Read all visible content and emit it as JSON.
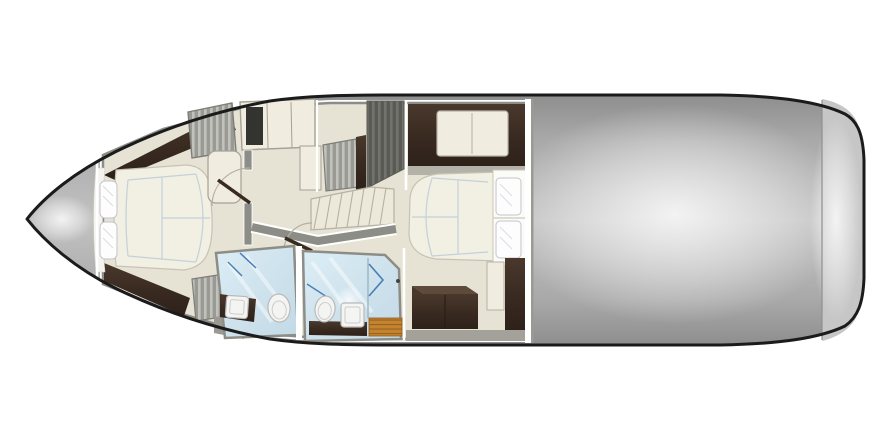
{
  "title": "Yacht lower-deck floor plan",
  "colors": {
    "background": "#ffffff",
    "hullOutline": "#1b1b1b",
    "deckGray": "#b0b0b0",
    "sternBand": "#c6c6c6",
    "wallGray": "#8d8d87",
    "wallGrayLight": "#b4b1a9",
    "floorCream": "#e7e3d4",
    "furnitureCream": "#f0ecdf",
    "bedCream": "#f2efe3",
    "stairCream": "#ece8da",
    "quiltBlue": "#bfcdd8",
    "darkPanel": "#33332f",
    "bathBlue": "#cfe3ee",
    "accentBlue": "#4a7fb5",
    "teak": "#c5832f",
    "pillowWhite": "#fdfdfd",
    "nicheWhite": "#fbfbf8",
    "headboardWhite": "#f4f3ee",
    "fixtureWhite": "#f4f4f2",
    "deckWedge": "#9b9993",
    "bottomBand": "#a3a19a"
  },
  "rooms": [
    {
      "id": "bow-deck",
      "label": "bow deck"
    },
    {
      "id": "forward-cabin",
      "label": "forward cabin",
      "features": [
        "island berth",
        "two pillows",
        "hanging lockers",
        "cabinet row",
        "vanity"
      ]
    },
    {
      "id": "forward-head",
      "label": "forward bathroom",
      "features": [
        "toilet",
        "washbasin"
      ]
    },
    {
      "id": "mid-head",
      "label": "mid bathroom with shower",
      "features": [
        "toilet",
        "washbasin",
        "teak shower grate"
      ]
    },
    {
      "id": "companionway",
      "label": "companionway stairs"
    },
    {
      "id": "mid-cabin",
      "label": "midship cabin",
      "features": [
        "double berth",
        "two pillows",
        "settee",
        "dresser"
      ]
    },
    {
      "id": "aft-deck",
      "label": "aft deck"
    },
    {
      "id": "stern-platform",
      "label": "stern platform band"
    }
  ]
}
